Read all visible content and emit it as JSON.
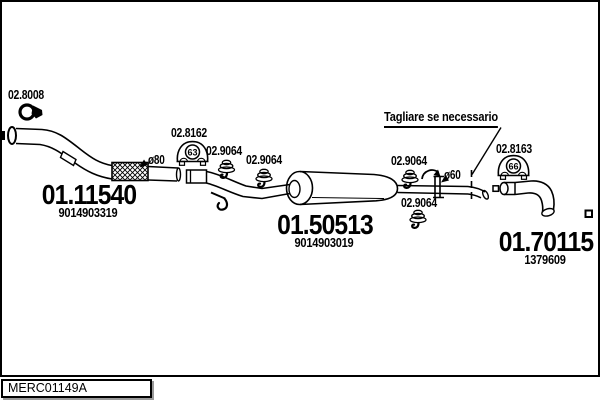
{
  "frame": {
    "code": "MERC01149A"
  },
  "note": "Tagliare se necessario",
  "dims": {
    "front": "ø80",
    "rear": "ø60"
  },
  "parts": {
    "front_clamp": {
      "ref": "02.8008"
    },
    "front_pipe": {
      "ref": "01.11540",
      "oem": "9014903319"
    },
    "mount_left": {
      "ref": "02.8162",
      "badge": "63"
    },
    "hanger_1": {
      "ref": "02.9064"
    },
    "hanger_2": {
      "ref": "02.9064"
    },
    "hanger_3": {
      "ref": "02.9064"
    },
    "hanger_4": {
      "ref": "02.9064"
    },
    "middle_silencer": {
      "ref": "01.50513",
      "oem": "9014903019"
    },
    "mount_right": {
      "ref": "02.8163",
      "badge": "66"
    },
    "tail_pipe": {
      "ref": "01.70115",
      "oem": "1379609"
    }
  }
}
